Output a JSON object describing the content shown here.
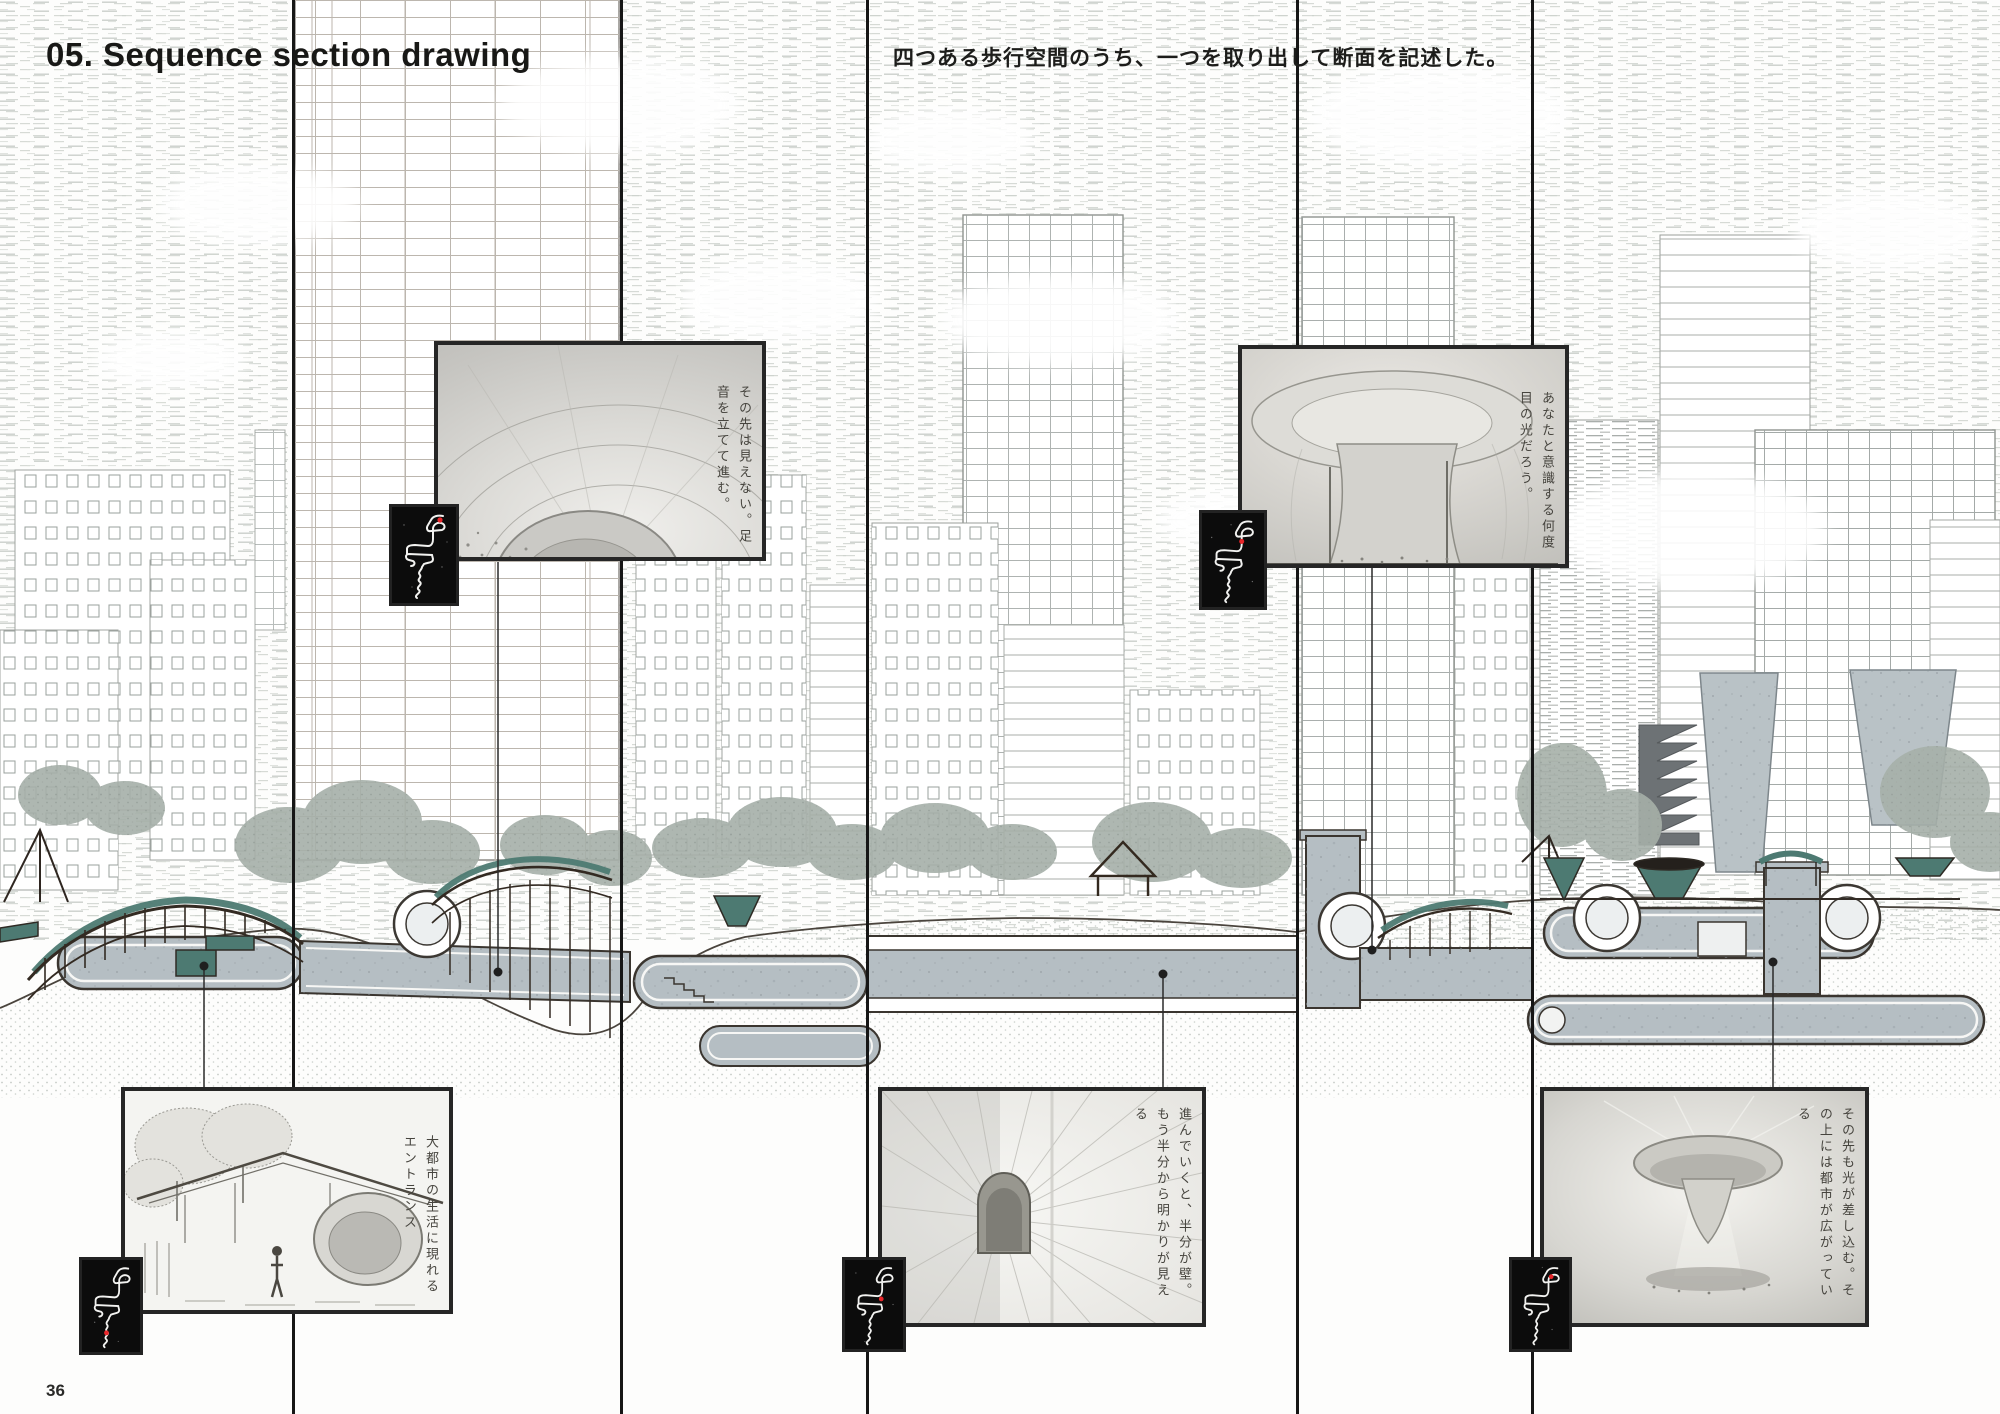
{
  "page": {
    "title": "05. Sequence section drawing",
    "note": "四つある歩行空間のうち、一つを取り出して断面を記述した。",
    "page_number": "36"
  },
  "insets": {
    "top_left": {
      "caption": "その先は見えない。足音を立てて進む。"
    },
    "top_right": {
      "caption": "あなたと意識する何度目の光だろう。"
    },
    "bottom_left": {
      "caption": "大都市の生活に現れるエントランス"
    },
    "bottom_center": {
      "caption": "進んでいくと、半分が壁。もう半分から明かりが見える"
    },
    "bottom_right": {
      "caption": "その先も光が差し込む。その上には都市が広がっている"
    }
  },
  "maps": [
    {
      "name": "route-map-1",
      "dot": {
        "x": 48,
        "y": 13
      }
    },
    {
      "name": "route-map-2",
      "dot": {
        "x": 41,
        "y": 29
      }
    },
    {
      "name": "route-map-3",
      "dot": {
        "x": 27,
        "y": 76
      }
    },
    {
      "name": "route-map-4",
      "dot": {
        "x": 40,
        "y": 42
      }
    },
    {
      "name": "route-map-5",
      "dot": {
        "x": 44,
        "y": 18
      }
    }
  ],
  "colors": {
    "accent_teal": "#4d7a72",
    "concrete_gray": "#b5bec3",
    "line_dark": "#3a352f",
    "route_red": "#e8262a",
    "section_line": "#161616"
  }
}
